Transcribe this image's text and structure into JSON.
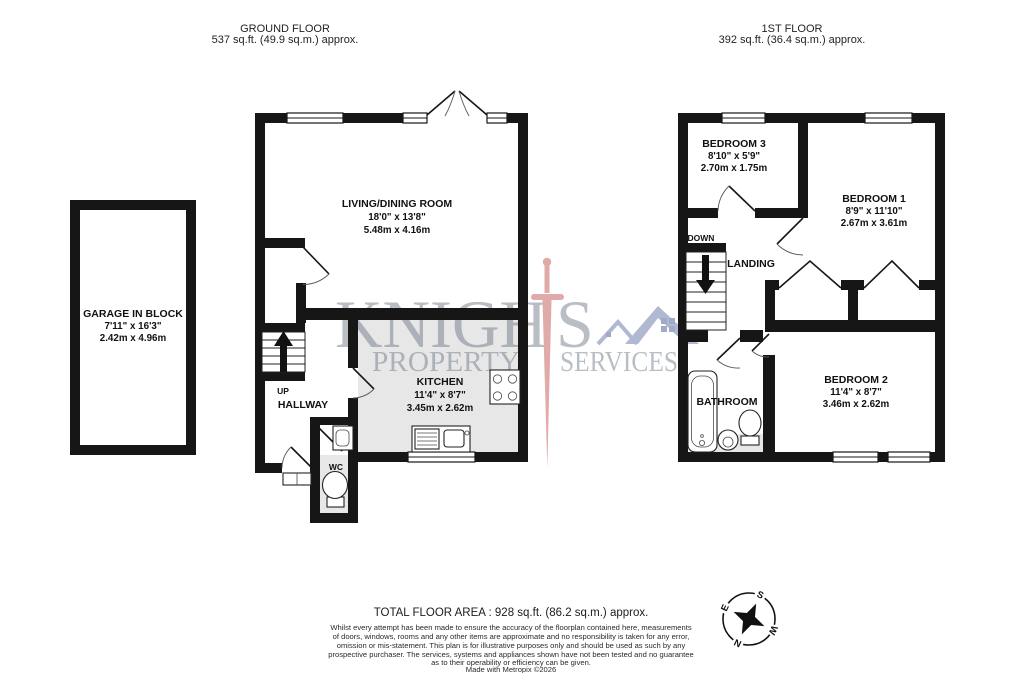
{
  "titles": {
    "ground_floor": "GROUND FLOOR",
    "ground_floor_area": "537 sq.ft. (49.9 sq.m.) approx.",
    "first_floor": "1ST FLOOR",
    "first_floor_area": "392 sq.ft. (36.4 sq.m.) approx."
  },
  "rooms": {
    "garage": {
      "name": "GARAGE IN BLOCK",
      "imperial": "7'11\" x 16'3\"",
      "metric": "2.42m x 4.96m"
    },
    "living_dining": {
      "name": "LIVING/DINING ROOM",
      "imperial": "18'0\" x 13'8\"",
      "metric": "5.48m x 4.16m"
    },
    "kitchen": {
      "name": "KITCHEN",
      "imperial": "11'4\" x 8'7\"",
      "metric": "3.45m x 2.62m"
    },
    "hallway": {
      "name": "HALLWAY"
    },
    "wc": {
      "name": "WC"
    },
    "bedroom1": {
      "name": "BEDROOM 1",
      "imperial": "8'9\" x 11'10\"",
      "metric": "2.67m x 3.61m"
    },
    "bedroom2": {
      "name": "BEDROOM 2",
      "imperial": "11'4\" x 8'7\"",
      "metric": "3.46m x 2.62m"
    },
    "bedroom3": {
      "name": "BEDROOM 3",
      "imperial": "8'10\" x 5'9\"",
      "metric": "2.70m x 1.75m"
    },
    "bathroom": {
      "name": "BATHROOM"
    },
    "landing": {
      "name": "LANDING"
    }
  },
  "stairs": {
    "up": "UP",
    "down": "DOWN"
  },
  "watermark": {
    "brand_left": "KNIGH",
    "brand_right": "S",
    "tagline_left": "PROPERTY",
    "tagline_right": "SERVICES"
  },
  "compass": {
    "n": "N",
    "e": "E",
    "s": "S",
    "w": "W"
  },
  "footer": {
    "total_area": "TOTAL FLOOR AREA : 928 sq.ft. (86.2 sq.m.) approx.",
    "disclaimer_lines": [
      "Whilst every attempt has been made to ensure the accuracy of the floorplan contained here, measurements",
      "of doors, windows, rooms and any other items are approximate and no responsibility is taken for any error,",
      "omission or mis-statement. This plan is for illustrative purposes only and should be used as such by any",
      "prospective purchaser. The services, systems and appliances shown have not been tested and no guarantee",
      "as to their operability or efficiency can be given.",
      "Made with Metropix ©2026"
    ]
  },
  "colors": {
    "wall": "#161616",
    "floor_shade": "#e7e7e7",
    "watermark_gray": "#6e7888",
    "watermark_red": "#c0504d",
    "watermark_blue": "#5e6fa3"
  }
}
